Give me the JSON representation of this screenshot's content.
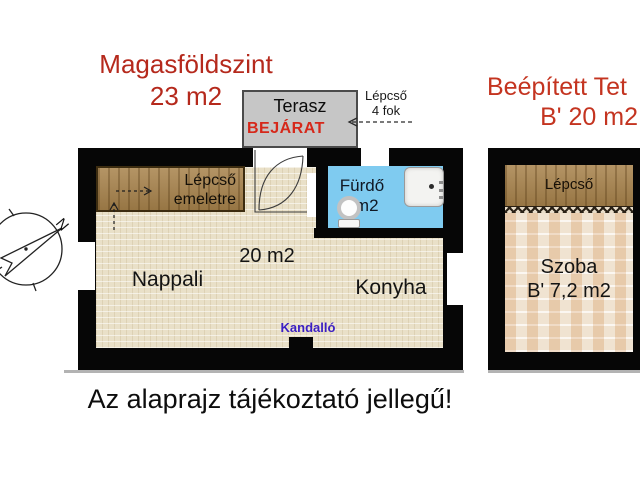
{
  "titles": {
    "left_line1": "Magasföldszint",
    "left_line2": "23 m2",
    "right_line1": "Beépített Tet",
    "right_line2": "B' 20 m2"
  },
  "terrace": {
    "name": "Terasz",
    "entrance": "BEJÁRAT"
  },
  "exterior_stairs": {
    "line1": "Lépcső",
    "line2": "4 fok"
  },
  "main_plan": {
    "stairs_line1": "Lépcső",
    "stairs_line2": "emeletre",
    "bathroom": "Fürdő 3m2",
    "area": "20 m2",
    "living_room": "Nappali",
    "kitchen": "Konyha",
    "fireplace": "Kandalló"
  },
  "attic_plan": {
    "stairs": "Lépcső",
    "room_line1": "Szoba",
    "room_line2": "B' 7,2 m2"
  },
  "footer": "Az alaprajz tájékoztató jellegű!",
  "compass": {
    "north": "N"
  },
  "colors": {
    "title_red": "#b5291c",
    "entrance_red": "#d6281a",
    "fireplace_blue": "#3b1fc4",
    "bathroom_blue": "#7fcbf0",
    "wall_black": "#060606",
    "floor_beige": "#e9e0c8",
    "wood_brown": "#a8834c",
    "brick_tan": "#ead7bd",
    "terrace_gray": "#c6c6c6"
  }
}
